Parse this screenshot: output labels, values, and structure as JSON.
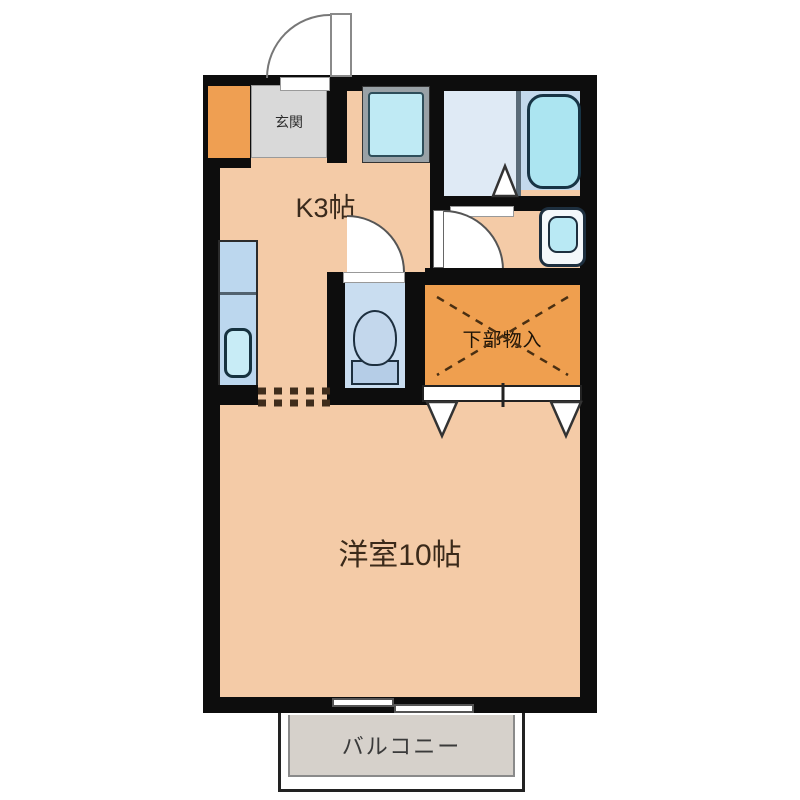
{
  "plan_title": "1K apartment floor plan",
  "rooms": {
    "kitchen": {
      "label": "K3帖"
    },
    "living": {
      "label": "洋室10帖"
    },
    "storage": {
      "label": "下部物入"
    },
    "balcony": {
      "label": "バルコニー"
    },
    "entrance": {
      "label": "玄関"
    }
  },
  "fixtures": [
    "entrance-door",
    "shoe-cabinet",
    "washing-machine-pan",
    "kitchen-counter-sink",
    "bathtub",
    "shower-drain",
    "wash-basin",
    "toilet",
    "closet-bifold-doors",
    "balcony-sliding-door"
  ],
  "colors": {
    "wall": "#0d0d0d",
    "floor_main": "#f4cba7",
    "storage_orange": "#ef9f4f",
    "shoebox_orange": "#ef9f52",
    "genkan_gray": "#d9d9d9",
    "bath_floor": "#dfeaf5",
    "tub_zone": "#c3d9ec",
    "fixture_cyan": "#aee6f2",
    "toilet_floor": "#c9ddf0",
    "counter_blue": "#bcd7ee",
    "balcony_gray": "#d6d1cb"
  }
}
